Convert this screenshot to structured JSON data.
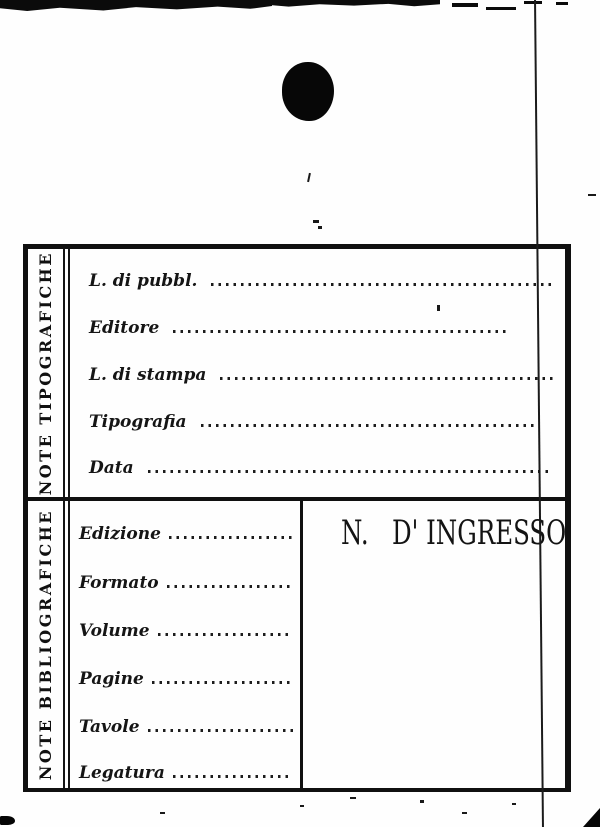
{
  "page": {
    "ink_color": "#141414",
    "paper_color": "#fefefe"
  },
  "card": {
    "sections": [
      {
        "side_label": "NOTE TIPOGRAFICHE",
        "rows": [
          {
            "label": "L. di pubbl."
          },
          {
            "label": "Editore"
          },
          {
            "label": "L. di stampa"
          },
          {
            "label": "Tipografia"
          },
          {
            "label": "Data"
          }
        ]
      },
      {
        "side_label": "NOTE BIBLIOGRAFICHE",
        "rows": [
          {
            "label": "Edizione"
          },
          {
            "label": "Formato"
          },
          {
            "label": "Volume"
          },
          {
            "label": "Pagine"
          },
          {
            "label": "Tavole"
          },
          {
            "label": "Legatura"
          }
        ],
        "ingresso_label": "N.   D' INGRESSO"
      }
    ]
  }
}
